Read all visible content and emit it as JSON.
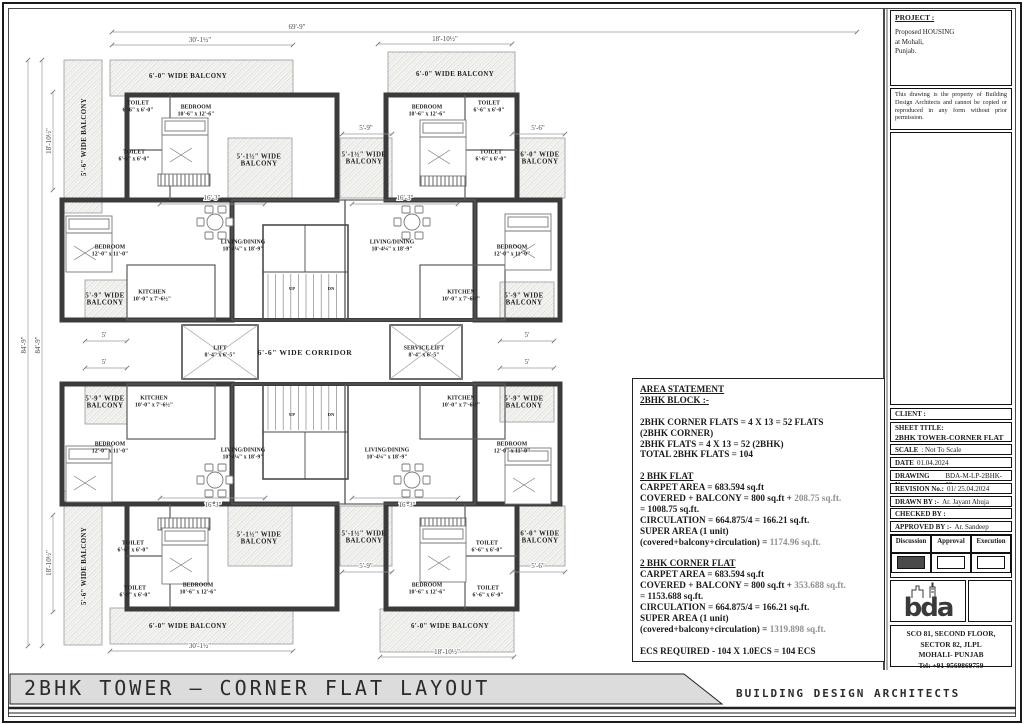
{
  "footer": {
    "sheet_title": "2BHK TOWER — CORNER FLAT LAYOUT",
    "firm": "BUILDING DESIGN ARCHITECTS"
  },
  "project": {
    "heading": "PROJECT :",
    "lines": [
      "Proposed HOUSING",
      "at Mohali,",
      "Punjab."
    ],
    "disclaimer": "This drawing is the property of Building Design Architects and cannot be copied or reproduced in any form without prior permission."
  },
  "title_block": {
    "rows": [
      {
        "label": "CLIENT :",
        "value": ""
      },
      {
        "label": "SHEET TITLE:",
        "value": "2BHK TOWER-CORNER FLAT LAYOUT",
        "stack": true
      },
      {
        "label": "SCALE",
        "value": ": Not To Scale"
      },
      {
        "label": "DATE",
        "value": "01.04.2024"
      },
      {
        "label": "DRAWING No.:",
        "value": "BDA-M-LP-2BHK-02"
      },
      {
        "label": "REVISION No.:",
        "value": "01/ 25.04.2024"
      },
      {
        "label": "DRAWN BY :-",
        "value": "Ar. Jayant Ahuja"
      },
      {
        "label": "CHECKED BY :",
        "value": ""
      },
      {
        "label": "APPROVED BY :-",
        "value": "Ar. Sandeep"
      }
    ],
    "approval_headers": [
      "Discussion",
      "Approval",
      "Execution"
    ],
    "approval_states": [
      true,
      false,
      false
    ],
    "logo_text": "bda",
    "address": [
      "SCO 81, SECOND FLOOR,",
      "SECTOR 82, JLPL",
      "MOHALI- PUNJAB",
      "Tel: +91-9569869759"
    ]
  },
  "area_statement": {
    "lines": [
      {
        "u": true,
        "parts": [
          {
            "t": "AREA STATEMENT"
          }
        ]
      },
      {
        "u": true,
        "parts": [
          {
            "t": "2BHK BLOCK :-"
          }
        ]
      },
      {
        "parts": []
      },
      {
        "parts": [
          {
            "t": "2BHK CORNER FLATS = 4 X 13 = 52 FLATS"
          }
        ]
      },
      {
        "parts": [
          {
            "t": "(2BHK CORNER)"
          }
        ]
      },
      {
        "parts": [
          {
            "t": "2BHK FLATS = 4 X 13 = 52 (2BHK)"
          }
        ]
      },
      {
        "parts": [
          {
            "t": "TOTAL 2BHK FLATS = 104"
          }
        ]
      },
      {
        "parts": []
      },
      {
        "u": true,
        "parts": [
          {
            "t": "2 BHK FLAT"
          }
        ]
      },
      {
        "parts": [
          {
            "t": "CARPET AREA = 683.594 sq.ft"
          }
        ]
      },
      {
        "parts": [
          {
            "t": "COVERED + BALCONY = 800 sq.ft + "
          },
          {
            "t": "208.75 sq.ft.",
            "g": true
          }
        ]
      },
      {
        "parts": [
          {
            "t": "= 1008.75 sq.ft."
          }
        ]
      },
      {
        "parts": [
          {
            "t": "CIRCULATION = 664.875/4 = 166.21 sq.ft."
          }
        ]
      },
      {
        "parts": [
          {
            "t": "SUPER AREA (1 unit)"
          }
        ]
      },
      {
        "parts": [
          {
            "t": "(covered+balcony+circulation) = "
          },
          {
            "t": "1174.96 sq.ft.",
            "g": true
          }
        ]
      },
      {
        "parts": []
      },
      {
        "u": true,
        "parts": [
          {
            "t": "2 BHK CORNER FLAT"
          }
        ]
      },
      {
        "parts": [
          {
            "t": "CARPET AREA = 683.594 sq.ft"
          }
        ]
      },
      {
        "parts": [
          {
            "t": "COVERED + BALCONY = 800 sq.ft + "
          },
          {
            "t": "353.688 sq.ft.",
            "g": true
          }
        ]
      },
      {
        "parts": [
          {
            "t": "= 1153.688 sq.ft."
          }
        ]
      },
      {
        "parts": [
          {
            "t": "CIRCULATION = 664.875/4 = 166.21 sq.ft."
          }
        ]
      },
      {
        "parts": [
          {
            "t": "SUPER AREA (1 unit)"
          }
        ]
      },
      {
        "parts": [
          {
            "t": "(covered+balcony+circulation) = "
          },
          {
            "t": "1319.898 sq.ft.",
            "g": true
          }
        ]
      },
      {
        "parts": []
      },
      {
        "parts": [
          {
            "t": "ECS REQUIRED - 104 X 1.0ECS = 104 ECS"
          }
        ]
      }
    ]
  },
  "plan": {
    "labels": [
      {
        "x": 138,
        "y": 106,
        "l": [
          "TOILET",
          "6'-6\" x 6'-0\""
        ],
        "s": "rm",
        "n": "room-label-toilet"
      },
      {
        "x": 196,
        "y": 110,
        "l": [
          "BEDROOM",
          "10'-6\" x 12'-6\""
        ],
        "s": "rm",
        "n": "room-label-bedroom"
      },
      {
        "x": 134,
        "y": 155,
        "l": [
          "TOILET",
          "6'-6\" x 6'-0\""
        ],
        "s": "rm",
        "n": "room-label-toilet"
      },
      {
        "x": 110,
        "y": 250,
        "l": [
          "BEDROOM",
          "12'-0\" x 11'-0\""
        ],
        "s": "rm",
        "n": "room-label-bedroom"
      },
      {
        "x": 243,
        "y": 245,
        "l": [
          "LIVING/DINING",
          "10'-4¼\" x 18'-9\""
        ],
        "s": "rm",
        "n": "room-label-living-dining"
      },
      {
        "x": 152,
        "y": 295,
        "l": [
          "KITCHEN",
          "10'-0\" x 7'-6½\""
        ],
        "s": "rm",
        "n": "room-label-kitchen"
      },
      {
        "x": 427,
        "y": 110,
        "l": [
          "BEDROOM",
          "10'-6\" x 12'-6\""
        ],
        "s": "rm",
        "n": "room-label-bedroom"
      },
      {
        "x": 489,
        "y": 106,
        "l": [
          "TOILET",
          "6'-6\" x 6'-0\""
        ],
        "s": "rm",
        "n": "room-label-toilet"
      },
      {
        "x": 491,
        "y": 155,
        "l": [
          "TOILET",
          "6'-6\" x 6'-0\""
        ],
        "s": "rm",
        "n": "room-label-toilet"
      },
      {
        "x": 512,
        "y": 250,
        "l": [
          "BEDROOM",
          "12'-0\" x 11'-0\""
        ],
        "s": "rm",
        "n": "room-label-bedroom"
      },
      {
        "x": 392,
        "y": 245,
        "l": [
          "LIVING/DINING",
          "10'-4¼\" x 18'-9\""
        ],
        "s": "rm",
        "n": "room-label-living-dining"
      },
      {
        "x": 461,
        "y": 295,
        "l": [
          "KITCHEN",
          "10'-0\" x 7'-6½\""
        ],
        "s": "rm",
        "n": "room-label-kitchen"
      },
      {
        "x": 135,
        "y": 591,
        "l": [
          "TOILET",
          "6'-6\" x 6'-0\""
        ],
        "s": "rm",
        "n": "room-label-toilet"
      },
      {
        "x": 198,
        "y": 588,
        "l": [
          "BEDROOM",
          "10'-6\" x 12'-6\""
        ],
        "s": "rm",
        "n": "room-label-bedroom"
      },
      {
        "x": 133,
        "y": 546,
        "l": [
          "TOILET",
          "6'-6\" x 6'-0\""
        ],
        "s": "rm",
        "n": "room-label-toilet"
      },
      {
        "x": 110,
        "y": 447,
        "l": [
          "BEDROOM",
          "12'-0\" x 11'-0\""
        ],
        "s": "rm",
        "n": "room-label-bedroom"
      },
      {
        "x": 243,
        "y": 453,
        "l": [
          "LIVING/DINING",
          "10'-4¼\" x 18'-9\""
        ],
        "s": "rm",
        "n": "room-label-living-dining"
      },
      {
        "x": 154,
        "y": 401,
        "l": [
          "KITCHEN",
          "10'-0\" x 7'-6½\""
        ],
        "s": "rm",
        "n": "room-label-kitchen"
      },
      {
        "x": 427,
        "y": 588,
        "l": [
          "BEDROOM",
          "10'-6\" x 12'-6\""
        ],
        "s": "rm",
        "n": "room-label-bedroom"
      },
      {
        "x": 488,
        "y": 591,
        "l": [
          "TOILET",
          "6'-6\" x 6'-0\""
        ],
        "s": "rm",
        "n": "room-label-toilet"
      },
      {
        "x": 487,
        "y": 546,
        "l": [
          "TOILET",
          "6'-6\" x 6'-0\""
        ],
        "s": "rm",
        "n": "room-label-toilet"
      },
      {
        "x": 512,
        "y": 447,
        "l": [
          "BEDROOM",
          "12'-0\" x 11'-0\""
        ],
        "s": "rm",
        "n": "room-label-bedroom"
      },
      {
        "x": 387,
        "y": 453,
        "l": [
          "LIVING/DINING",
          "10'-4¼\" x 18'-9\""
        ],
        "s": "rm",
        "n": "room-label-living-dining"
      },
      {
        "x": 461,
        "y": 401,
        "l": [
          "KITCHEN",
          "10'-0\" x 7'-6½\""
        ],
        "s": "rm",
        "n": "room-label-kitchen"
      },
      {
        "x": 220,
        "y": 351,
        "l": [
          "LIFT",
          "8'-4\" x 6'-5\""
        ],
        "s": "rm",
        "n": "room-label-lift"
      },
      {
        "x": 424,
        "y": 351,
        "l": [
          "SERVICE LIFT",
          "8'-4\" x 6'-5\""
        ],
        "s": "rm",
        "n": "room-label-service-lift"
      },
      {
        "x": 305,
        "y": 353,
        "l": [
          "6'-6\" WIDE CORRIDOR"
        ],
        "s": "cor",
        "n": "corridor-label"
      },
      {
        "x": 292,
        "y": 288,
        "l": [
          "UP"
        ],
        "s": "xs",
        "n": "stair-up-label"
      },
      {
        "x": 331,
        "y": 288,
        "l": [
          "DN"
        ],
        "s": "xs",
        "n": "stair-dn-label"
      },
      {
        "x": 292,
        "y": 414,
        "l": [
          "UP"
        ],
        "s": "xs",
        "n": "stair-up-label"
      },
      {
        "x": 331,
        "y": 414,
        "l": [
          "DN"
        ],
        "s": "xs",
        "n": "stair-dn-label"
      },
      {
        "x": 188,
        "y": 76,
        "l": [
          "6'-0\" WIDE BALCONY"
        ],
        "s": "bal",
        "n": "balcony-label"
      },
      {
        "x": 84,
        "y": 137,
        "l": [
          "5'-6\" WIDE BALCONY"
        ],
        "s": "bal",
        "rot": -90,
        "n": "balcony-label"
      },
      {
        "x": 259,
        "y": 160,
        "l": [
          "5'-1½\" WIDE",
          "BALCONY"
        ],
        "s": "bal",
        "n": "balcony-label"
      },
      {
        "x": 105,
        "y": 299,
        "l": [
          "5'-9\" WIDE",
          "BALCONY"
        ],
        "s": "bal",
        "n": "balcony-label"
      },
      {
        "x": 455,
        "y": 74,
        "l": [
          "6'-0\" WIDE BALCONY"
        ],
        "s": "bal",
        "n": "balcony-label"
      },
      {
        "x": 364,
        "y": 158,
        "l": [
          "5'-1½\" WIDE",
          "BALCONY"
        ],
        "s": "bal",
        "n": "balcony-label"
      },
      {
        "x": 540,
        "y": 158,
        "l": [
          "6'-0\" WIDE",
          "BALCONY"
        ],
        "s": "bal",
        "n": "balcony-label"
      },
      {
        "x": 524,
        "y": 299,
        "l": [
          "5'-9\" WIDE",
          "BALCONY"
        ],
        "s": "bal",
        "n": "balcony-label"
      },
      {
        "x": 188,
        "y": 626,
        "l": [
          "6'-0\" WIDE BALCONY"
        ],
        "s": "bal",
        "n": "balcony-label"
      },
      {
        "x": 84,
        "y": 566,
        "l": [
          "5'-6\" WIDE BALCONY"
        ],
        "s": "bal",
        "rot": -90,
        "n": "balcony-label"
      },
      {
        "x": 259,
        "y": 538,
        "l": [
          "5'-1½\" WIDE",
          "BALCONY"
        ],
        "s": "bal",
        "n": "balcony-label"
      },
      {
        "x": 105,
        "y": 402,
        "l": [
          "5'-9\" WIDE",
          "BALCONY"
        ],
        "s": "bal",
        "n": "balcony-label"
      },
      {
        "x": 450,
        "y": 626,
        "l": [
          "6'-0\" WIDE BALCONY"
        ],
        "s": "bal",
        "n": "balcony-label"
      },
      {
        "x": 364,
        "y": 537,
        "l": [
          "5'-1½\" WIDE",
          "BALCONY"
        ],
        "s": "bal",
        "n": "balcony-label"
      },
      {
        "x": 540,
        "y": 537,
        "l": [
          "6'-0\" WIDE",
          "BALCONY"
        ],
        "s": "bal",
        "n": "balcony-label"
      },
      {
        "x": 524,
        "y": 402,
        "l": [
          "5'-9\" WIDE",
          "BALCONY"
        ],
        "s": "bal",
        "n": "balcony-label"
      }
    ],
    "dims": [
      {
        "t": "69'-9\"",
        "x1": 112,
        "y1": 32,
        "x2": 857,
        "y2": 32,
        "lx": 297,
        "ly": 29
      },
      {
        "t": "30'-1½\"",
        "x1": 112,
        "y1": 45,
        "x2": 293,
        "y2": 45,
        "lx": 200,
        "ly": 42
      },
      {
        "t": "18'-10½\"",
        "x1": 378,
        "y1": 44,
        "x2": 512,
        "y2": 44,
        "lx": 445,
        "ly": 41
      },
      {
        "t": "84'-9\"",
        "x1": 28,
        "y1": 60,
        "x2": 28,
        "y2": 646,
        "lx": 26,
        "ly": 345,
        "rot": -90
      },
      {
        "t": "84'-9\"",
        "x1": 42,
        "y1": 60,
        "x2": 42,
        "y2": 646,
        "lx": 40,
        "ly": 345,
        "rot": -90
      },
      {
        "t": "18'-10½\"",
        "x1": 53,
        "y1": 92,
        "x2": 53,
        "y2": 190,
        "lx": 51,
        "ly": 141,
        "rot": -90
      },
      {
        "t": "18'-10½\"",
        "x1": 53,
        "y1": 515,
        "x2": 53,
        "y2": 612,
        "lx": 51,
        "ly": 563,
        "rot": -90
      },
      {
        "t": "5'-9\"",
        "x1": 342,
        "y1": 134,
        "x2": 392,
        "y2": 134,
        "lx": 366,
        "ly": 130
      },
      {
        "t": "5'-6\"",
        "x1": 512,
        "y1": 134,
        "x2": 565,
        "y2": 134,
        "lx": 538,
        "ly": 130
      },
      {
        "t": "5'-9\"",
        "x1": 342,
        "y1": 572,
        "x2": 392,
        "y2": 572,
        "lx": 366,
        "ly": 568
      },
      {
        "t": "5'-6\"",
        "x1": 512,
        "y1": 572,
        "x2": 565,
        "y2": 572,
        "lx": 538,
        "ly": 568
      },
      {
        "t": "16'-3\"",
        "x1": 160,
        "y1": 204,
        "x2": 265,
        "y2": 204,
        "lx": 212,
        "ly": 200
      },
      {
        "t": "16'-3\"",
        "x1": 352,
        "y1": 204,
        "x2": 458,
        "y2": 204,
        "lx": 405,
        "ly": 200
      },
      {
        "t": "16'-3\"",
        "x1": 160,
        "y1": 498,
        "x2": 265,
        "y2": 498,
        "lx": 213,
        "ly": 507
      },
      {
        "t": "16'-3\"",
        "x1": 352,
        "y1": 498,
        "x2": 458,
        "y2": 498,
        "lx": 407,
        "ly": 507
      },
      {
        "t": "5'",
        "x1": 85,
        "y1": 341,
        "x2": 127,
        "y2": 341,
        "lx": 104,
        "ly": 337
      },
      {
        "t": "5'",
        "x1": 85,
        "y1": 368,
        "x2": 127,
        "y2": 368,
        "lx": 104,
        "ly": 364
      },
      {
        "t": "5'",
        "x1": 500,
        "y1": 341,
        "x2": 554,
        "y2": 341,
        "lx": 527,
        "ly": 337
      },
      {
        "t": "5'",
        "x1": 500,
        "y1": 368,
        "x2": 554,
        "y2": 368,
        "lx": 527,
        "ly": 364
      },
      {
        "t": "30'-1½\"",
        "x1": 110,
        "y1": 651,
        "x2": 293,
        "y2": 651,
        "lx": 200,
        "ly": 648
      },
      {
        "t": "18'-10½\"",
        "x1": 380,
        "y1": 657,
        "x2": 514,
        "y2": 657,
        "lx": 447,
        "ly": 654
      }
    ]
  }
}
